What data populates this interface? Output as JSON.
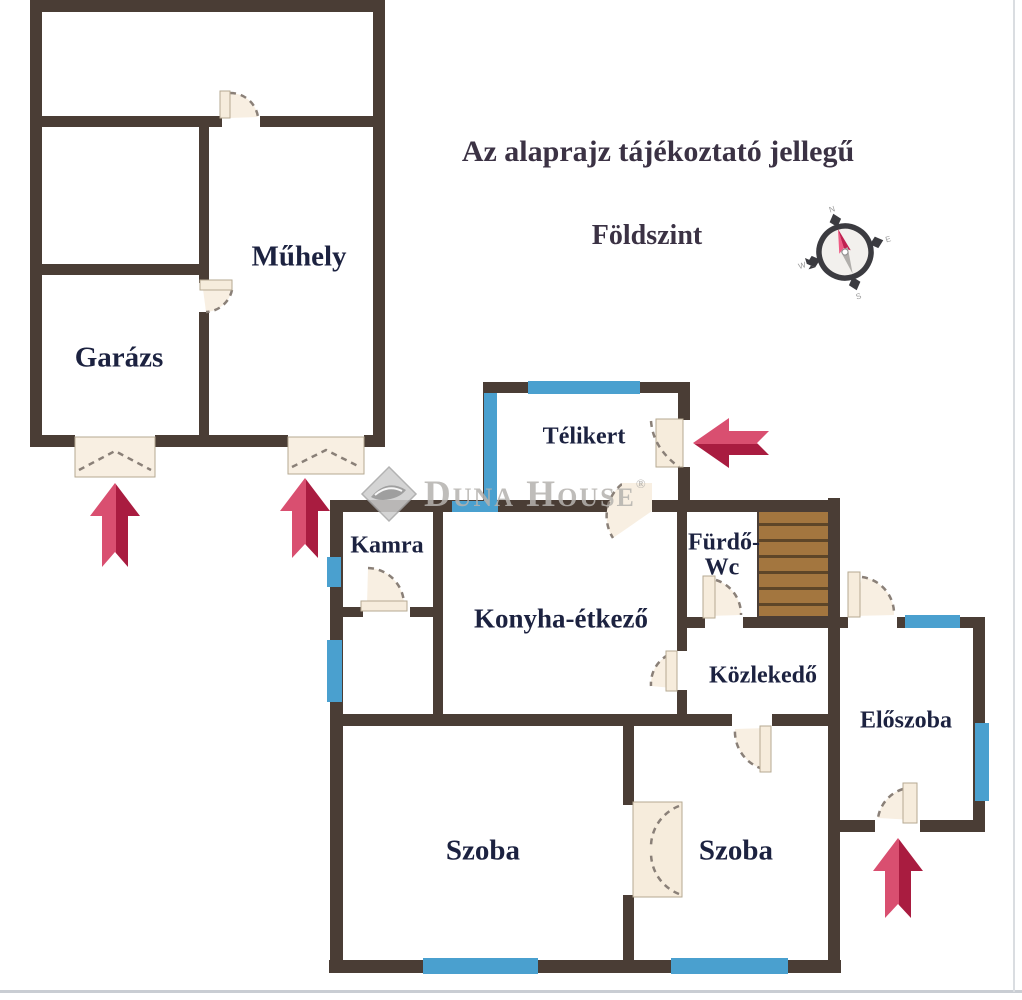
{
  "notes": {
    "disclaimer": "Az alaprajz tájékoztató jellegű",
    "floor": "Földszint"
  },
  "watermark": {
    "brand": "Duna House",
    "registered_mark": "®"
  },
  "compass": {
    "north": "N",
    "east": "E",
    "south": "S",
    "west": "W"
  },
  "rooms": {
    "muhely": "Műhely",
    "garazs": "Garázs",
    "telikert": "Télikert",
    "kamra": "Kamra",
    "konyha_etkezo": "Konyha-étkező",
    "furdo_line1": "Fürdő-",
    "furdo_line2": "Wc",
    "kozlekedo": "Közlekedő",
    "eloszoba": "Előszoba",
    "szoba_left": "Szoba",
    "szoba_right": "Szoba"
  },
  "colors": {
    "wall": "#4a3d35",
    "window": "#4aa0cf",
    "door_leaf": "#f6ecdc",
    "arrow_light": "#d94f70",
    "arrow_dark": "#a91c40",
    "stairs_wood": "#a3763f",
    "room_label": "#1c2240",
    "title_text": "#3b3244",
    "watermark_gray": "#b5b2ae"
  }
}
